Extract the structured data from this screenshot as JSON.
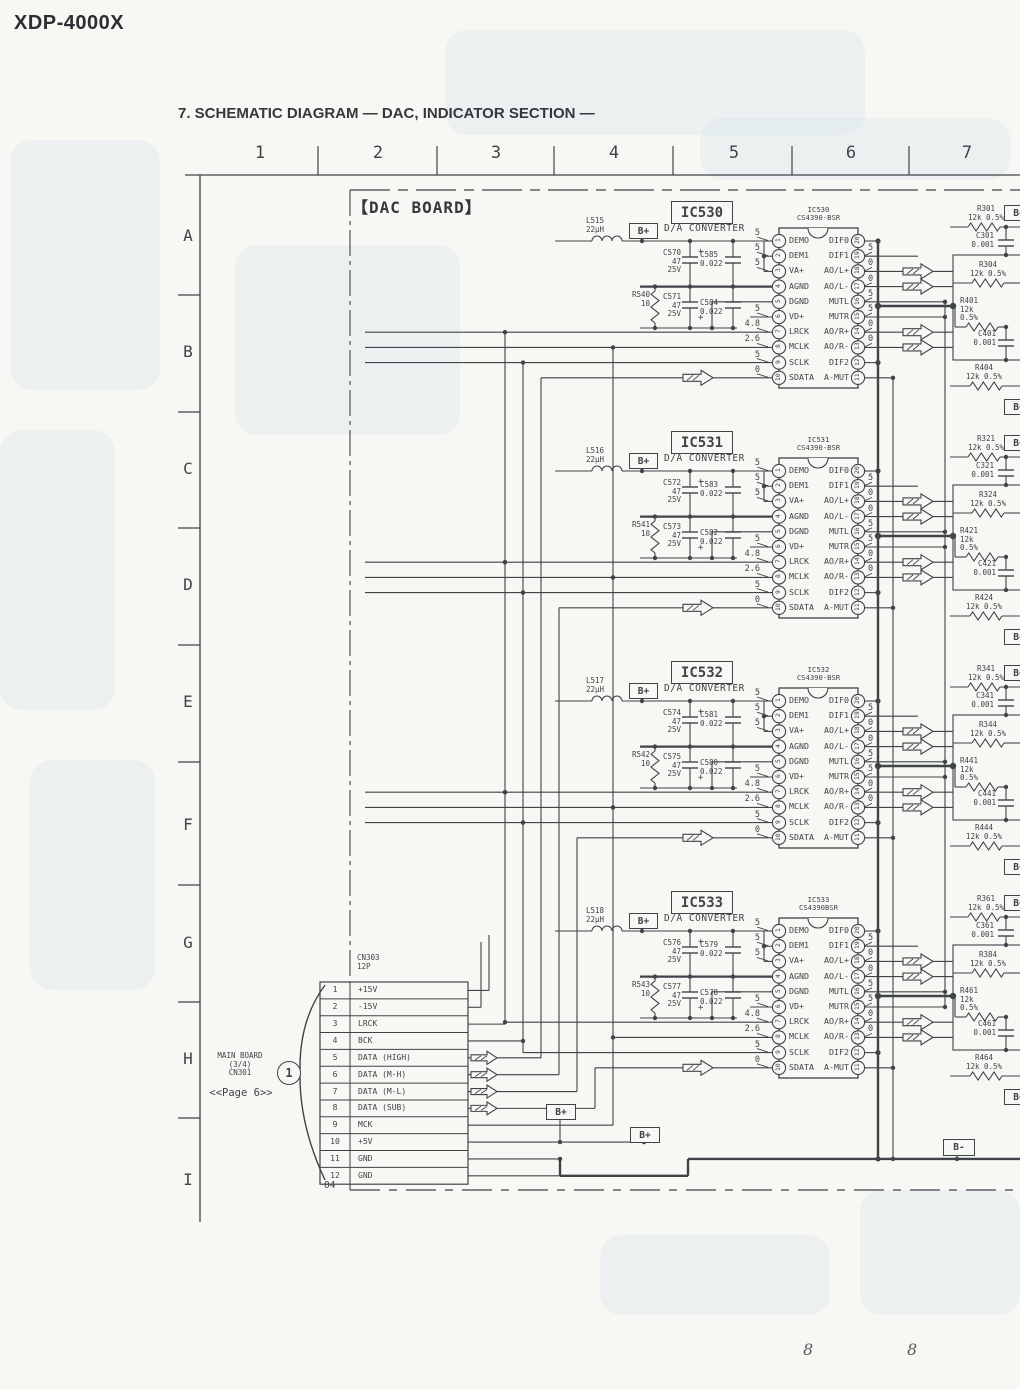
{
  "page": {
    "model": "XDP-4000X",
    "section_title": "7. SCHEMATIC DIAGRAM — DAC, INDICATOR SECTION —",
    "board_label": "【DAC BOARD】",
    "board_corner_ref": "04",
    "footer_pages": [
      "8",
      "8"
    ]
  },
  "grid": {
    "columns": [
      "1",
      "2",
      "3",
      "4",
      "5",
      "6",
      "7"
    ],
    "rows": [
      "A",
      "B",
      "C",
      "D",
      "E",
      "F",
      "G",
      "H",
      "I"
    ]
  },
  "net_labels": {
    "b_plus": "B+",
    "b_minus": "B-",
    "b_clipped": "B+"
  },
  "connector": {
    "ref": "CN303",
    "size": "12P",
    "circle_ref": "1",
    "link_lines": [
      "MAIN BOARD",
      "(3/4)",
      "CN301"
    ],
    "page_ref": "<<Page 6>>",
    "pins": [
      {
        "no": "1",
        "label": "+15V"
      },
      {
        "no": "2",
        "label": "-15V"
      },
      {
        "no": "3",
        "label": "LRCK"
      },
      {
        "no": "4",
        "label": "BCK"
      },
      {
        "no": "5",
        "label": "DATA (HIGH)"
      },
      {
        "no": "6",
        "label": "DATA (M-H)"
      },
      {
        "no": "7",
        "label": "DATA (M-L)"
      },
      {
        "no": "8",
        "label": "DATA (SUB)"
      },
      {
        "no": "9",
        "label": "MCK"
      },
      {
        "no": "10",
        "label": "+5V"
      },
      {
        "no": "11",
        "label": "GND"
      },
      {
        "no": "12",
        "label": "GND"
      }
    ]
  },
  "ics": [
    {
      "ref": "IC530",
      "function": "D/A CONVERTER",
      "part": "CS4390-BSR",
      "rail": "B+",
      "inductor": {
        "ref": "L515",
        "value": "22μH"
      },
      "decoupling": {
        "c_a": {
          "ref": "C570",
          "value": "47",
          "voltage": "25V"
        },
        "c_b": {
          "ref": "C585",
          "value": "0.022"
        },
        "r": {
          "ref": "R540",
          "value": "10"
        },
        "c_c": {
          "ref": "C571",
          "value": "47",
          "voltage": "25V"
        },
        "c_d": {
          "ref": "C584",
          "value": "0.022"
        }
      },
      "left_pins": [
        {
          "n": "1",
          "name": "DEMO",
          "v": "5"
        },
        {
          "n": "2",
          "name": "DEM1",
          "v": "5"
        },
        {
          "n": "3",
          "name": "VA+",
          "v": "5"
        },
        {
          "n": "4",
          "name": "AGND",
          "v": ""
        },
        {
          "n": "5",
          "name": "DGND",
          "v": ""
        },
        {
          "n": "6",
          "name": "VD+",
          "v": "5"
        },
        {
          "n": "7",
          "name": "LRCK",
          "v": "4.8"
        },
        {
          "n": "8",
          "name": "MCLK",
          "v": "2.6"
        },
        {
          "n": "9",
          "name": "SCLK",
          "v": "5"
        },
        {
          "n": "10",
          "name": "SDATA",
          "v": "0"
        }
      ],
      "right_pins": [
        {
          "n": "20",
          "name": "DIF0",
          "v": ""
        },
        {
          "n": "19",
          "name": "DIF1",
          "v": "5"
        },
        {
          "n": "18",
          "name": "AO/L+",
          "v": "0"
        },
        {
          "n": "17",
          "name": "AO/L-",
          "v": "0"
        },
        {
          "n": "16",
          "name": "MUTL",
          "v": "5"
        },
        {
          "n": "15",
          "name": "MUTR",
          "v": "5"
        },
        {
          "n": "14",
          "name": "AO/R+",
          "v": "0"
        },
        {
          "n": "13",
          "name": "AO/R-",
          "v": "0"
        },
        {
          "n": "12",
          "name": "DIF2",
          "v": ""
        },
        {
          "n": "11",
          "name": "A-MUT",
          "v": ""
        }
      ],
      "output_network": {
        "r1": {
          "ref": "R301",
          "value": "12k 0.5%"
        },
        "c1": {
          "ref": "C301",
          "value": "0.001"
        },
        "r2": {
          "ref": "R304",
          "value": "12k 0.5%"
        },
        "r3": {
          "ref": "R401",
          "value": "12k",
          "tol": "0.5%"
        },
        "c2": {
          "ref": "C401",
          "value": "0.001"
        },
        "r4": {
          "ref": "R404",
          "value": "12k 0.5%"
        }
      }
    },
    {
      "ref": "IC531",
      "function": "D/A CONVERTER",
      "part": "CS4390-BSR",
      "rail": "B+",
      "inductor": {
        "ref": "L516",
        "value": "22μH"
      },
      "decoupling": {
        "c_a": {
          "ref": "C572",
          "value": "47",
          "voltage": "25V"
        },
        "c_b": {
          "ref": "C583",
          "value": "0.022"
        },
        "r": {
          "ref": "R541",
          "value": "10"
        },
        "c_c": {
          "ref": "C573",
          "value": "47",
          "voltage": "25V"
        },
        "c_d": {
          "ref": "C582",
          "value": "0.022"
        }
      },
      "left_pins": [
        {
          "n": "1",
          "name": "DEMO",
          "v": "5"
        },
        {
          "n": "2",
          "name": "DEM1",
          "v": "5"
        },
        {
          "n": "3",
          "name": "VA+",
          "v": "5"
        },
        {
          "n": "4",
          "name": "AGND",
          "v": ""
        },
        {
          "n": "5",
          "name": "DGND",
          "v": ""
        },
        {
          "n": "6",
          "name": "VD+",
          "v": "5"
        },
        {
          "n": "7",
          "name": "LRCK",
          "v": "4.8"
        },
        {
          "n": "8",
          "name": "MCLK",
          "v": "2.6"
        },
        {
          "n": "9",
          "name": "SCLK",
          "v": "5"
        },
        {
          "n": "10",
          "name": "SDATA",
          "v": "0"
        }
      ],
      "right_pins": [
        {
          "n": "20",
          "name": "DIF0",
          "v": ""
        },
        {
          "n": "19",
          "name": "DIF1",
          "v": "5"
        },
        {
          "n": "18",
          "name": "AO/L+",
          "v": "0"
        },
        {
          "n": "17",
          "name": "AO/L-",
          "v": "0"
        },
        {
          "n": "16",
          "name": "MUTL",
          "v": "5"
        },
        {
          "n": "15",
          "name": "MUTR",
          "v": "5"
        },
        {
          "n": "14",
          "name": "AO/R+",
          "v": "0"
        },
        {
          "n": "13",
          "name": "AO/R-",
          "v": "0"
        },
        {
          "n": "12",
          "name": "DIF2",
          "v": ""
        },
        {
          "n": "11",
          "name": "A-MUT",
          "v": ""
        }
      ],
      "output_network": {
        "r1": {
          "ref": "R321",
          "value": "12k 0.5%"
        },
        "c1": {
          "ref": "C321",
          "value": "0.001"
        },
        "r2": {
          "ref": "R324",
          "value": "12k 0.5%"
        },
        "r3": {
          "ref": "R421",
          "value": "12k",
          "tol": "0.5%"
        },
        "c2": {
          "ref": "C421",
          "value": "0.001"
        },
        "r4": {
          "ref": "R424",
          "value": "12k 0.5%"
        }
      }
    },
    {
      "ref": "IC532",
      "function": "D/A CONVERTER",
      "part": "CS4390-BSR",
      "rail": "B+",
      "inductor": {
        "ref": "L517",
        "value": "22μH"
      },
      "decoupling": {
        "c_a": {
          "ref": "C574",
          "value": "47",
          "voltage": "25V"
        },
        "c_b": {
          "ref": "C581",
          "value": "0.022"
        },
        "r": {
          "ref": "R542",
          "value": "10"
        },
        "c_c": {
          "ref": "C575",
          "value": "47",
          "voltage": "25V"
        },
        "c_d": {
          "ref": "C580",
          "value": "0.022"
        }
      },
      "left_pins": [
        {
          "n": "1",
          "name": "DEMO",
          "v": "5"
        },
        {
          "n": "2",
          "name": "DEM1",
          "v": "5"
        },
        {
          "n": "3",
          "name": "VA+",
          "v": "5"
        },
        {
          "n": "4",
          "name": "AGND",
          "v": ""
        },
        {
          "n": "5",
          "name": "DGND",
          "v": ""
        },
        {
          "n": "6",
          "name": "VD+",
          "v": "5"
        },
        {
          "n": "7",
          "name": "LRCK",
          "v": "4.8"
        },
        {
          "n": "8",
          "name": "MCLK",
          "v": "2.6"
        },
        {
          "n": "9",
          "name": "SCLK",
          "v": "5"
        },
        {
          "n": "10",
          "name": "SDATA",
          "v": "0"
        }
      ],
      "right_pins": [
        {
          "n": "20",
          "name": "DIF0",
          "v": ""
        },
        {
          "n": "19",
          "name": "DIF1",
          "v": "5"
        },
        {
          "n": "18",
          "name": "AO/L+",
          "v": "0"
        },
        {
          "n": "17",
          "name": "AO/L-",
          "v": "0"
        },
        {
          "n": "16",
          "name": "MUTL",
          "v": "5"
        },
        {
          "n": "15",
          "name": "MUTR",
          "v": "5"
        },
        {
          "n": "14",
          "name": "AO/R+",
          "v": "0"
        },
        {
          "n": "13",
          "name": "AO/R-",
          "v": "0"
        },
        {
          "n": "12",
          "name": "DIF2",
          "v": ""
        },
        {
          "n": "11",
          "name": "A-MUT",
          "v": ""
        }
      ],
      "output_network": {
        "r1": {
          "ref": "R341",
          "value": "12k 0.5%"
        },
        "c1": {
          "ref": "C341",
          "value": "0.001"
        },
        "r2": {
          "ref": "R344",
          "value": "12k 0.5%"
        },
        "r3": {
          "ref": "R441",
          "value": "12k",
          "tol": "0.5%"
        },
        "c2": {
          "ref": "C441",
          "value": "0.001"
        },
        "r4": {
          "ref": "R444",
          "value": "12k 0.5%"
        }
      }
    },
    {
      "ref": "IC533",
      "function": "D/A CONVERTER",
      "part": "CS4390BSR",
      "rail": "B+",
      "inductor": {
        "ref": "L518",
        "value": "22μH"
      },
      "decoupling": {
        "c_a": {
          "ref": "C576",
          "value": "47",
          "voltage": "25V"
        },
        "c_b": {
          "ref": "C579",
          "value": "0.022"
        },
        "r": {
          "ref": "R543",
          "value": "10"
        },
        "c_c": {
          "ref": "C577",
          "value": "47",
          "voltage": "25V"
        },
        "c_d": {
          "ref": "C578",
          "value": "0.022"
        }
      },
      "left_pins": [
        {
          "n": "1",
          "name": "DEMO",
          "v": "5"
        },
        {
          "n": "2",
          "name": "DEM1",
          "v": "5"
        },
        {
          "n": "3",
          "name": "VA+",
          "v": "5"
        },
        {
          "n": "4",
          "name": "AGND",
          "v": ""
        },
        {
          "n": "5",
          "name": "DGND",
          "v": ""
        },
        {
          "n": "6",
          "name": "VD+",
          "v": "5"
        },
        {
          "n": "7",
          "name": "LRCK",
          "v": "4.8"
        },
        {
          "n": "8",
          "name": "MCLK",
          "v": "2.6"
        },
        {
          "n": "9",
          "name": "SCLK",
          "v": "5"
        },
        {
          "n": "10",
          "name": "SDATA",
          "v": "0"
        }
      ],
      "right_pins": [
        {
          "n": "20",
          "name": "DIF0",
          "v": ""
        },
        {
          "n": "19",
          "name": "DIF1",
          "v": "5"
        },
        {
          "n": "18",
          "name": "AO/L+",
          "v": "0"
        },
        {
          "n": "17",
          "name": "AO/L-",
          "v": "0"
        },
        {
          "n": "16",
          "name": "MUTL",
          "v": "5"
        },
        {
          "n": "15",
          "name": "MUTR",
          "v": "5"
        },
        {
          "n": "14",
          "name": "AO/R+",
          "v": "0"
        },
        {
          "n": "13",
          "name": "AO/R-",
          "v": "0"
        },
        {
          "n": "12",
          "name": "DIF2",
          "v": ""
        },
        {
          "n": "11",
          "name": "A-MUT",
          "v": ""
        }
      ],
      "output_network": {
        "r1": {
          "ref": "R361",
          "value": "12k 0.5%"
        },
        "c1": {
          "ref": "C361",
          "value": "0.001"
        },
        "r2": {
          "ref": "R384",
          "value": "12k 0.5%"
        },
        "r3": {
          "ref": "R461",
          "value": "12k",
          "tol": "0.5%"
        },
        "c2": {
          "ref": "C461",
          "value": "0.001"
        },
        "r4": {
          "ref": "R464",
          "value": "12k 0.5%"
        }
      }
    }
  ]
}
